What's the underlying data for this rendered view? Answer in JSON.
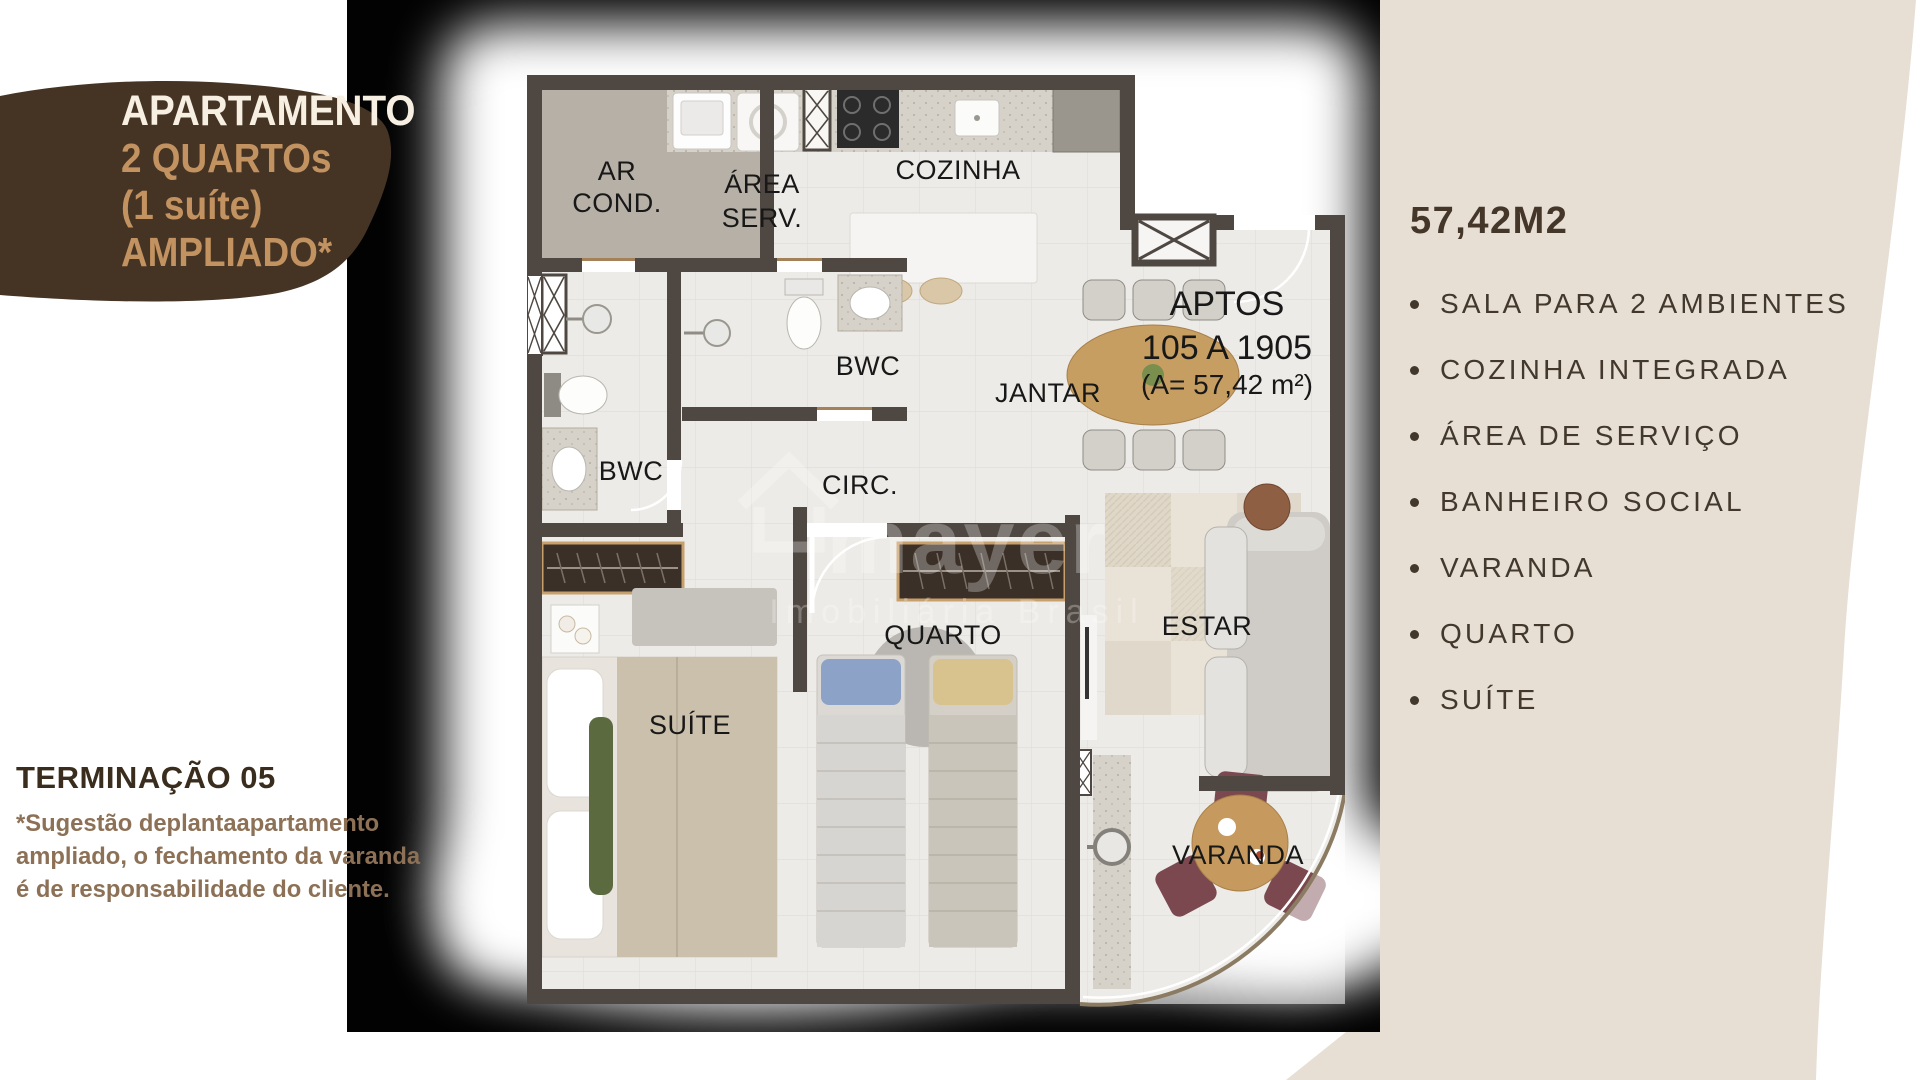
{
  "promo_blob": {
    "title": "APARTAMENTO",
    "subtitle_lines": [
      "2 QUARTOs",
      "(1 suíte)",
      "AMPLIADO*"
    ],
    "bg_color": "#453424",
    "title_color": "#f6efe2",
    "subtitle_color": "#c29260"
  },
  "termination": {
    "title": "TERMINAÇÃO 05",
    "note_lines": [
      "*Sugestão deplantaapartamento",
      "ampliado, o fechamento da varanda",
      "é de responsabilidade do cliente."
    ]
  },
  "specs": {
    "area_title": "57,42M2",
    "items": [
      "SALA PARA 2 AMBIENTES",
      "COZINHA INTEGRADA",
      "ÁREA DE SERVIÇO",
      "BANHEIRO SOCIAL",
      "VARANDA",
      "QUARTO",
      "SUÍTE"
    ]
  },
  "floorplan": {
    "rooms": [
      {
        "id": "ar-cond",
        "lines": [
          "AR",
          "COND."
        ]
      },
      {
        "id": "area-serv",
        "lines": [
          "ÁREA",
          "SERV."
        ]
      },
      {
        "id": "cozinha",
        "lines": [
          "COZINHA"
        ]
      },
      {
        "id": "bwc-social",
        "lines": [
          "BWC"
        ]
      },
      {
        "id": "bwc-suite",
        "lines": [
          "BWC"
        ]
      },
      {
        "id": "circ",
        "lines": [
          "CIRC."
        ]
      },
      {
        "id": "jantar",
        "lines": [
          "JANTAR"
        ]
      },
      {
        "id": "quarto",
        "lines": [
          "QUARTO"
        ]
      },
      {
        "id": "estar",
        "lines": [
          "ESTAR"
        ]
      },
      {
        "id": "suite",
        "lines": [
          "SUÍTE"
        ]
      },
      {
        "id": "varanda",
        "lines": [
          "VARANDA"
        ]
      }
    ],
    "apts_label": {
      "line1": "APTOS",
      "line2": "105 A 1905",
      "line3": "(A= 57,42 m²)"
    },
    "watermark": {
      "brand": "mayer",
      "subtitle": "Imobiliária Brasil"
    }
  },
  "colors": {
    "beige_shape": "#e7ded4",
    "plan_wall": "#4f4842",
    "plan_floor": "#edebe7",
    "accent_tan": "#c29260",
    "dark_brown": "#3a2d1d",
    "note_brown": "#8d7156",
    "list_text": "#42382c"
  }
}
